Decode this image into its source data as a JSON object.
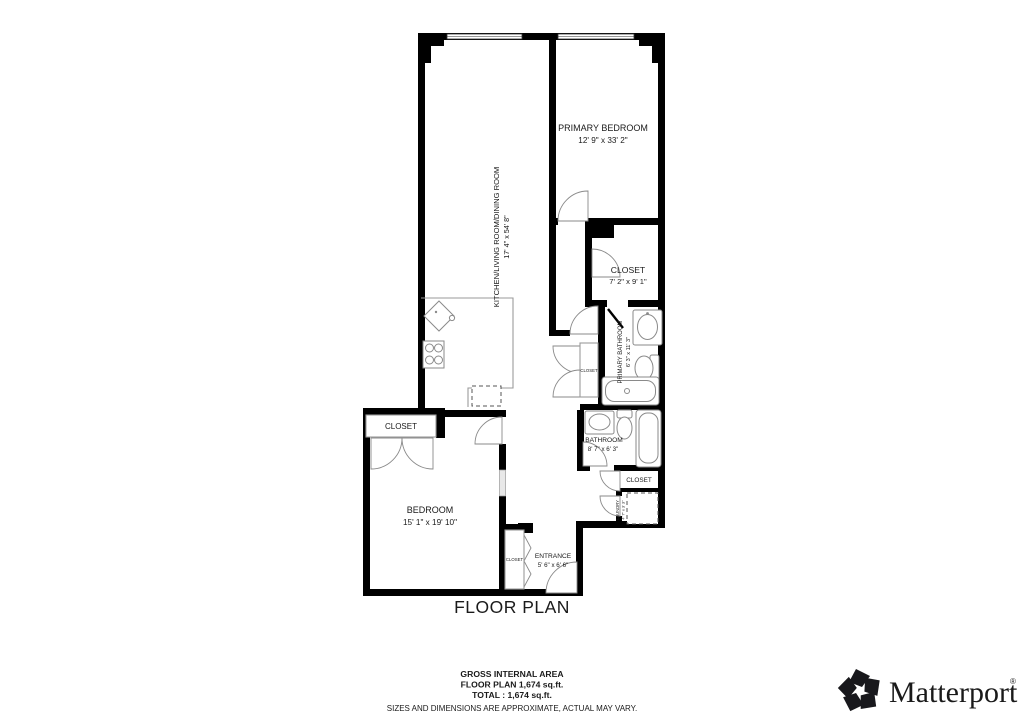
{
  "title": "FLOOR PLAN",
  "rooms": {
    "kitchen_living_dining": {
      "name": "KITCHEN/LIVING ROOM/DINING ROOM",
      "dims": "17' 4\" x 54' 8\""
    },
    "primary_bedroom": {
      "name": "PRIMARY BEDROOM",
      "dims": "12' 9\" x 33' 2\""
    },
    "primary_closet": {
      "name": "CLOSET",
      "dims": "7' 2\" x 9' 1\""
    },
    "primary_bathroom": {
      "name": "PRIMARY BATHROOM",
      "dims": "6' 3\" x 11' 3\""
    },
    "bathroom": {
      "name": "BATHROOM",
      "dims": "8' 7\" x 6' 3\""
    },
    "bedroom": {
      "name": "BEDROOM",
      "dims": "15' 1\" x 19' 10\""
    },
    "entrance": {
      "name": "ENTRANCE",
      "dims": "5' 6\" x 6' 6\""
    },
    "bedroom_closet": {
      "name": "CLOSET"
    },
    "hall_closet": {
      "name": "CLOSET"
    },
    "entrance_closet": {
      "name": "CLOSET"
    },
    "linen_closet": {
      "name": "CLOSET"
    },
    "laundry": {
      "name": "LAUNDRY",
      "dims": "4' 7\" x 3' 3\""
    }
  },
  "footer": {
    "area_heading": "GROSS INTERNAL AREA",
    "area_line1": "FLOOR PLAN 1,674 sq.ft.",
    "area_line2": "TOTAL :  1,674 sq.ft.",
    "disclaimer": "SIZES AND DIMENSIONS ARE APPROXIMATE, ACTUAL MAY VARY."
  },
  "branding": {
    "logo_text": "Matterport",
    "registered_mark": "®"
  },
  "colors": {
    "wall": "#000000",
    "fixture_line": "#8a8a8a",
    "text": "#1a1a1a",
    "disclaimer_text": "#9b9b9b"
  }
}
